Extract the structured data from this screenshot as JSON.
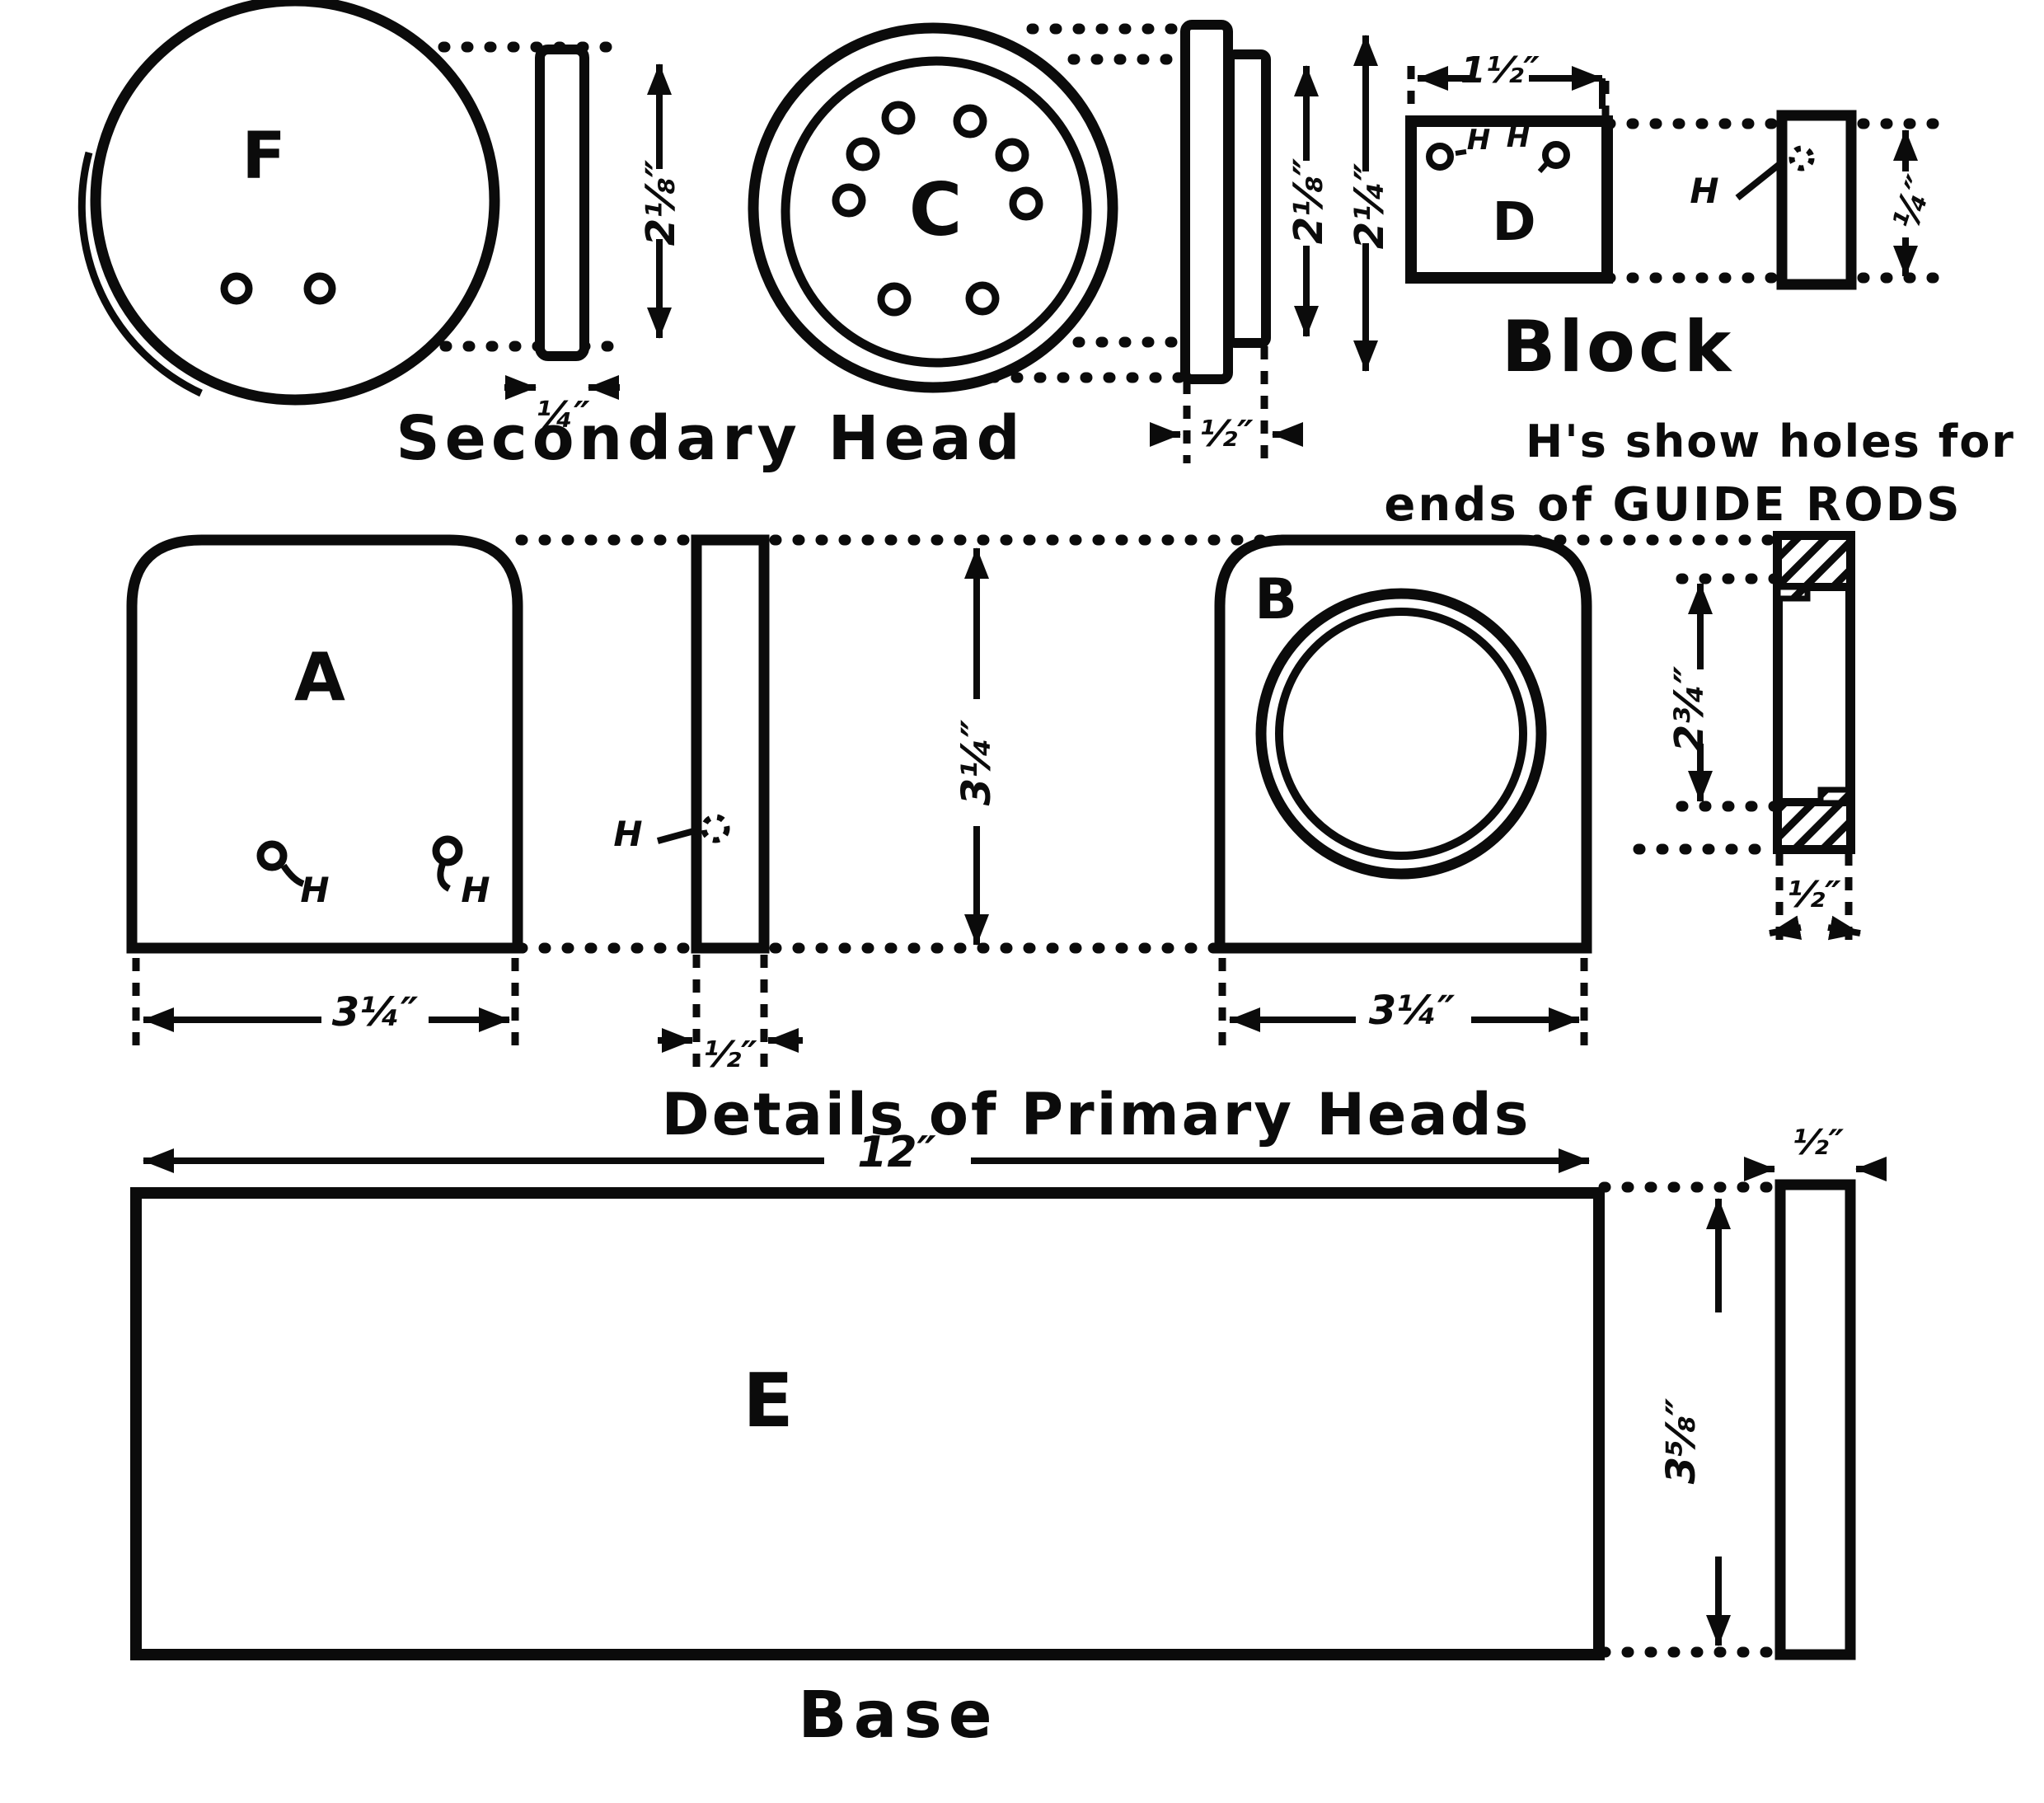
{
  "captions": {
    "secondary_head": "Secondary Head",
    "block": "Block",
    "note_line1": "H's show holes for",
    "note_line2": "ends of GUIDE RODS",
    "primary_heads": "Details of Primary Heads",
    "base": "Base"
  },
  "part_labels": {
    "f": "F",
    "c": "C",
    "d": "D",
    "a": "A",
    "b": "B",
    "e": "E"
  },
  "hole_labels": {
    "a_left": "H",
    "a_right": "H",
    "strip": "H",
    "d_inner_left": "H",
    "d_inner_right": "H",
    "d_side": "H"
  },
  "dimensions": {
    "f_height": "2⅛″",
    "f_thickness": "¼″",
    "c_inner_height": "2⅛″",
    "c_outer_height": "2¼″",
    "c_thickness": "½″",
    "d_width": "1½″",
    "d_thickness": "¼″",
    "a_width": "3¼″",
    "heads_height": "3¼″",
    "a_thickness": "½″",
    "b_width": "3¼″",
    "b_side_opening": "2¾″",
    "b_thickness": "½″",
    "e_width": "12″",
    "e_height": "3⅝″",
    "e_thickness": "½″"
  },
  "colors": {
    "ink": "#0b0b0b",
    "paper": "#ffffff"
  }
}
